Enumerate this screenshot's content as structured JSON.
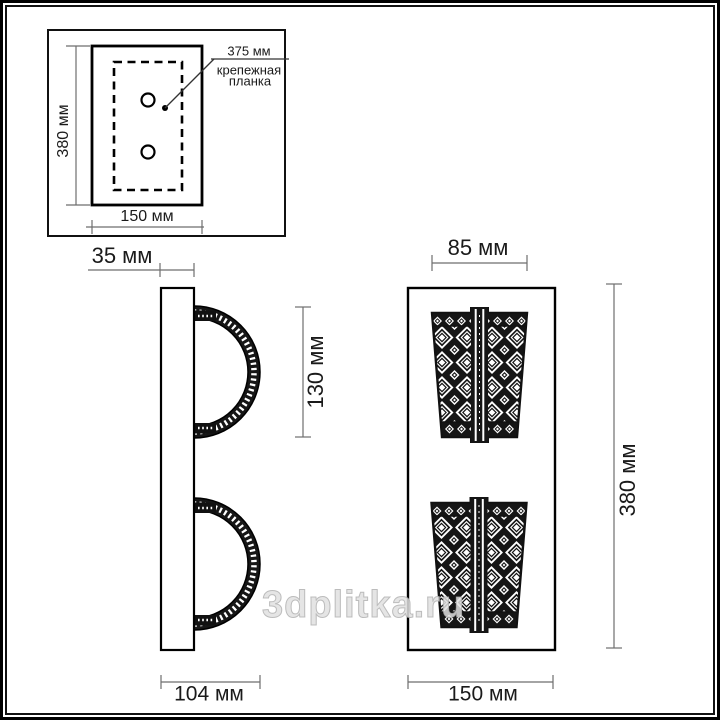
{
  "watermark": {
    "text": "3dplitka.ru"
  },
  "colors": {
    "ink": "#1a1a1a",
    "dim_line": "#6e6e6e",
    "watermark": "#dedede"
  },
  "mounting_plate_inset": {
    "height_label": "380 мм",
    "width_label": "150 мм",
    "hole_spacing_label": "375 мм",
    "mounting_bar_caption_line1": "крепежная",
    "mounting_bar_caption_line2": "планка"
  },
  "side_view": {
    "plate_depth_label": "35 мм",
    "shade_height_label": "130 мм",
    "total_depth_label": "104 мм"
  },
  "front_view": {
    "shade_width_label": "85 мм",
    "total_height_label": "380 мм",
    "total_width_label": "150 мм"
  }
}
